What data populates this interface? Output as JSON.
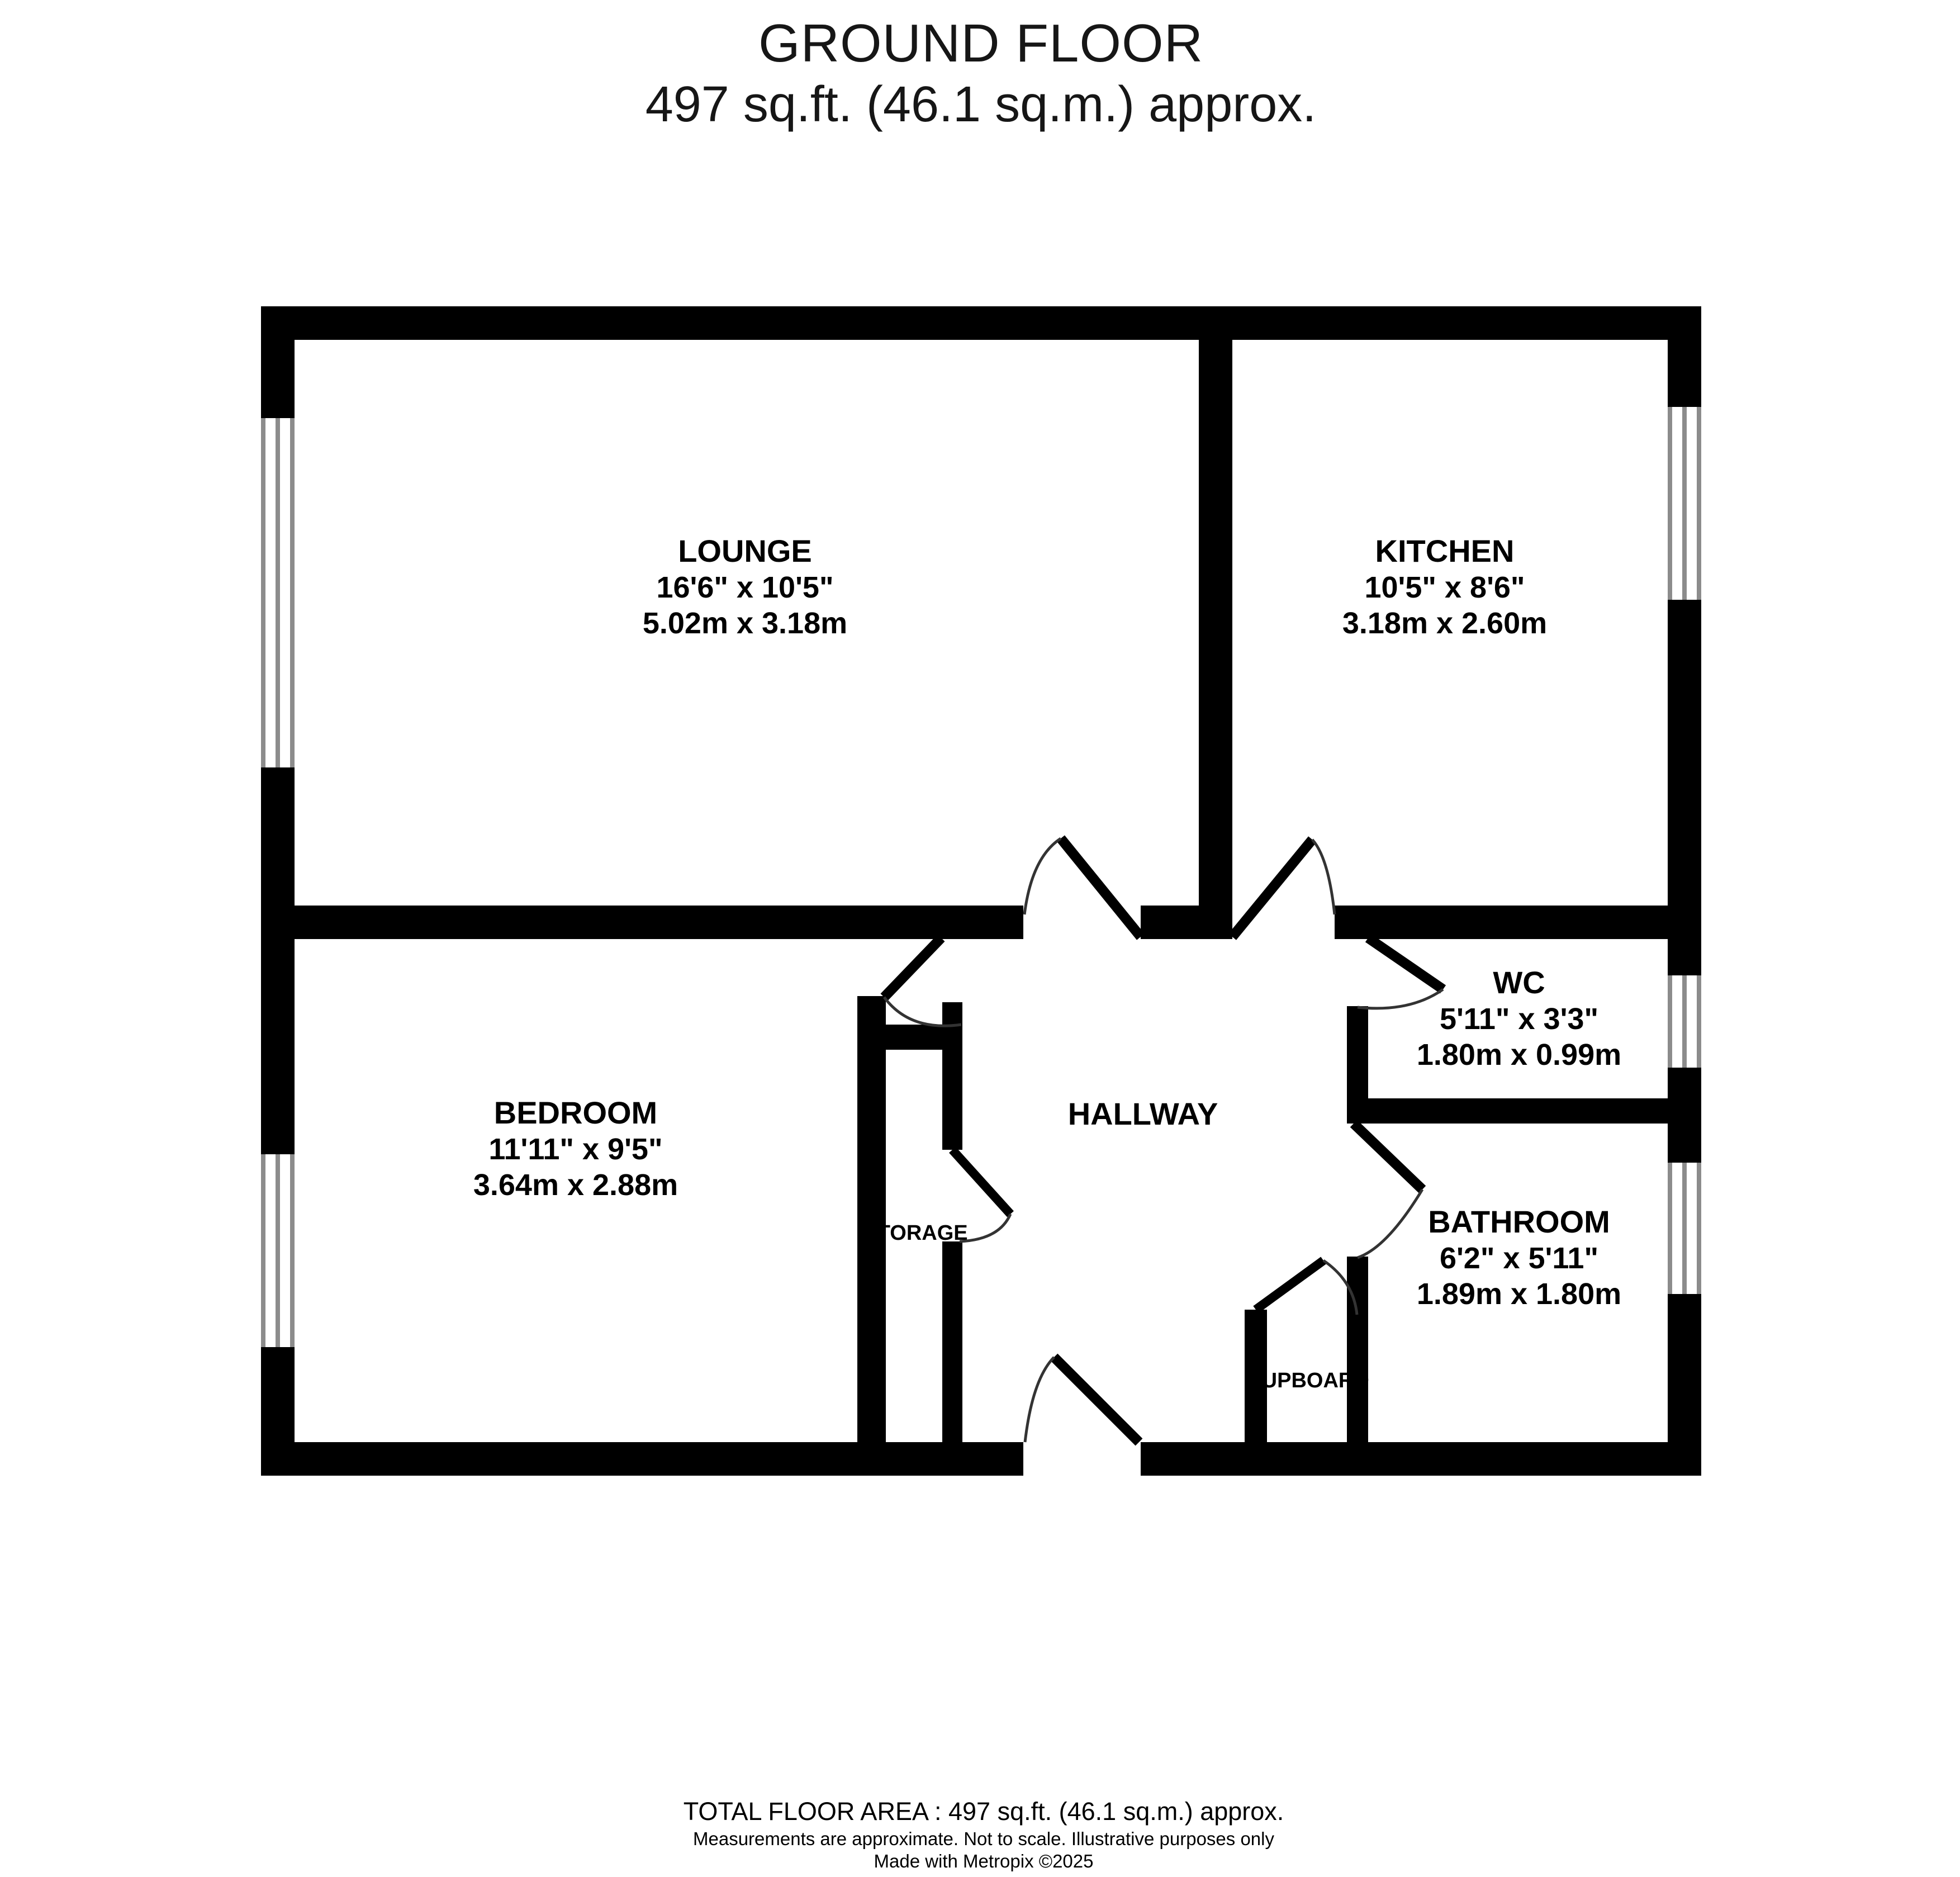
{
  "title": {
    "line1": "GROUND FLOOR",
    "line2": "497 sq.ft. (46.1 sq.m.) approx."
  },
  "rooms": {
    "lounge": {
      "name": "LOUNGE",
      "imperial": "16'6\"  x 10'5\"",
      "metric": "5.02m  x 3.18m"
    },
    "kitchen": {
      "name": "KITCHEN",
      "imperial": "10'5\"  x 8'6\"",
      "metric": "3.18m  x 2.60m"
    },
    "wc": {
      "name": "WC",
      "imperial": "5'11\"  x 3'3\"",
      "metric": "1.80m  x 0.99m"
    },
    "bedroom": {
      "name": "BEDROOM",
      "imperial": "11'11\"  x 9'5\"",
      "metric": "3.64m  x 2.88m"
    },
    "bathroom": {
      "name": "BATHROOM",
      "imperial": "6'2\"  x 5'11\"",
      "metric": "1.89m  x 1.80m"
    },
    "hallway": {
      "name": "HALLWAY"
    },
    "storage": {
      "name": "STORAGE"
    },
    "cupboard": {
      "name": "CUPBOARD"
    }
  },
  "footer": {
    "line1": "TOTAL FLOOR AREA : 497 sq.ft. (46.1 sq.m.) approx.",
    "line2": "Measurements are approximate.  Not to scale.  Illustrative purposes only",
    "line3": "Made with Metropix ©2025"
  },
  "colors": {
    "wall": "#000000",
    "window_frame": "#8c8c8c",
    "door_arc": "#333333",
    "background": "#ffffff"
  }
}
